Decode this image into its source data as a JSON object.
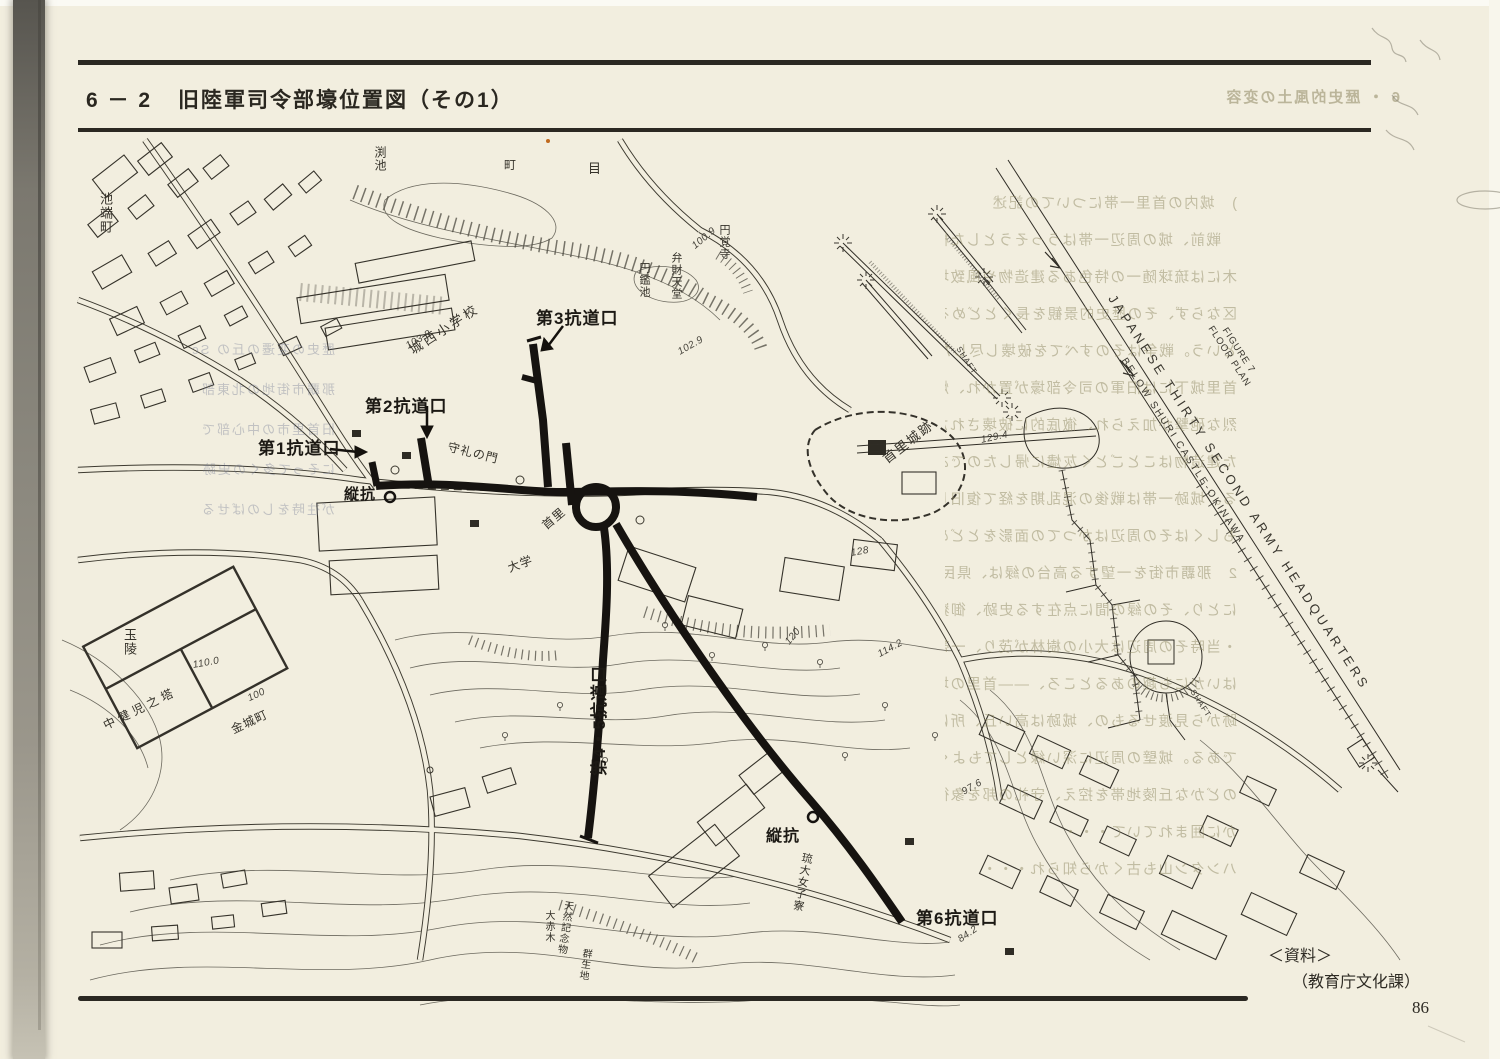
{
  "page": {
    "header": {
      "section": "6 － 2",
      "title": "旧陸軍司令部壕位置図（その1）"
    },
    "footer": {
      "source_label": "＜資料＞",
      "source_credit": "（教育庁文化課）",
      "page_number": "86"
    },
    "bleed_header": "6 ・ 歴史的風土の変容",
    "colors": {
      "paper": "#f2eedf",
      "ink": "#38352c",
      "bold_ink": "#161310",
      "bleed": "#aaa58b"
    }
  },
  "map": {
    "tunnel_labels": {
      "adit3": "第3抗道口",
      "adit2": "第2抗道口",
      "adit1": "第1抗道口",
      "shaft_west": "縦抗",
      "adit45": "第4・5抗道口",
      "shaft_south": "縦抗",
      "adit6": "第6抗道口"
    },
    "place_labels": {
      "ikehata": "池端町",
      "pond": "渕池",
      "machi": "町",
      "me": "目",
      "enkakuji": "円覚寺",
      "enkanchi": "円鑑池",
      "benzaitendo": "弁財天堂",
      "josei_school": "城西小学校",
      "shurei_gate": "守礼の門",
      "shuri_castle": "首里城跡",
      "shuri": "首里",
      "daigaku": "大学",
      "tamaudun": "玉陵",
      "chukenji_tower": "中健児之塔",
      "kinjo": "金城町",
      "ryudai_dorm": "琉大女子寮",
      "monument1": "天然記念物",
      "monument2": "大赤木",
      "monument3": "群生地"
    },
    "elevations": {
      "e1": "103.8",
      "e2": "102.9",
      "e3": "100.9",
      "e4": "129.4",
      "e5": "110.0",
      "e6": "100",
      "e7": "120",
      "e8": "114.2",
      "e9": "128",
      "e10": "97.6",
      "e11": "84.2"
    }
  },
  "floor_plan": {
    "figure_line1": "FIGURE 7",
    "figure_line2": "FLOOR PLAN",
    "title": "JAPANESE THIRTY SECOND ARMY HEADQUARTERS",
    "subtitle": "BELOW SHURI CASTLE-OKINAWA",
    "shaft": "SHAFT"
  },
  "bleedthrough": {
    "right_lines": [
      ")　城内の首里一帯についての記述",
      "　戦前、城の周辺一帯はうっそうとした樹",
      "木には琉球随一の特色ある建造物や風致地",
      "区ならず、その歴史的景観を長くとどめる",
      "という。戦争はそのすべてを破壊し尽した",
      "首里城下には旧軍の司令部壕が置かれ、熾",
      "烈な砲撃が加えられ、徹底的に破壊された",
      "た建造物はことごとく灰燼に帰したのであ",
      "る。城跡一帯は戦後の混乱期を経て復旧し",
      "もしくはその周辺はかつての面影をとどめ",
      "2　那覇市街を一望する高台の緑は、県民",
      "にとり、その緑の間に点在する史跡、御嶽",
      "・当時その周辺は大小の樹林が茂り、一帯",
      "はいかにも趣のあるところ、――首里の城",
      "跡から見渡せるもの、城跡は高い丘、所は",
      "である。城壁の周辺に深い緑としてもよく",
      "のどかな丘陵地帯を控え、守礼の邦を象徴",
      "かに囲まれていて・・・",
      "ハンタン山も古くから知られ・・・"
    ],
    "left_lines": [
      "歴史の変遷の丘の Sc",
      "那覇市街地の北東部",
      "旧首里市の中心部で",
      "にそって多くの史跡",
      "が往時をしのばせる"
    ]
  }
}
